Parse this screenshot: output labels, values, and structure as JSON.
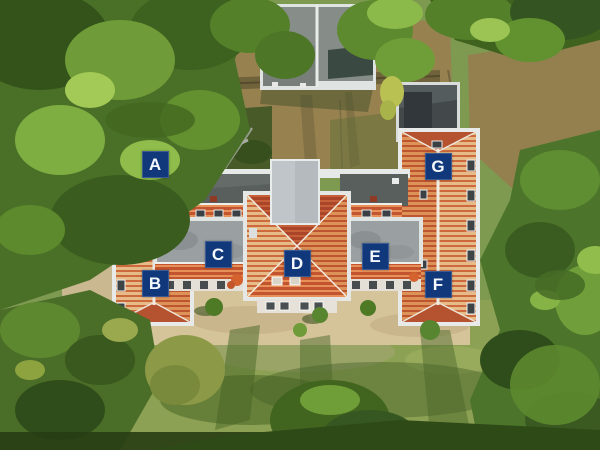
{
  "scene": {
    "type": "aerial-photograph",
    "subject": "top-down drone view of an apartment building complex with red tiled roofs, surrounded by trees, lawn and dirt ground"
  },
  "annotation": {
    "shape": "square",
    "bg_color": "#11387b",
    "text_color": "#f4f7fb"
  },
  "labels": [
    {
      "id": "A",
      "x": 155,
      "y": 164
    },
    {
      "id": "B",
      "x": 155,
      "y": 283
    },
    {
      "id": "C",
      "x": 218,
      "y": 254
    },
    {
      "id": "D",
      "x": 297,
      "y": 263
    },
    {
      "id": "E",
      "x": 375,
      "y": 256
    },
    {
      "id": "F",
      "x": 438,
      "y": 284
    },
    {
      "id": "G",
      "x": 438,
      "y": 166
    }
  ],
  "palette": {
    "roof_tile_light": "#e7bb88",
    "roof_tile_stripe": "#cc6a3d",
    "roof_hip_red": "#b5522f",
    "flat_roof_gray": "#9aa0a2",
    "dark_roof_gray": "#585f5c",
    "trim_white": "#e7eae8",
    "grass": "#7e9950",
    "dirt": "#97824f",
    "sand": "#d2c096",
    "forest_dark": "#3a5c1e",
    "forest_light": "#7eae41"
  }
}
